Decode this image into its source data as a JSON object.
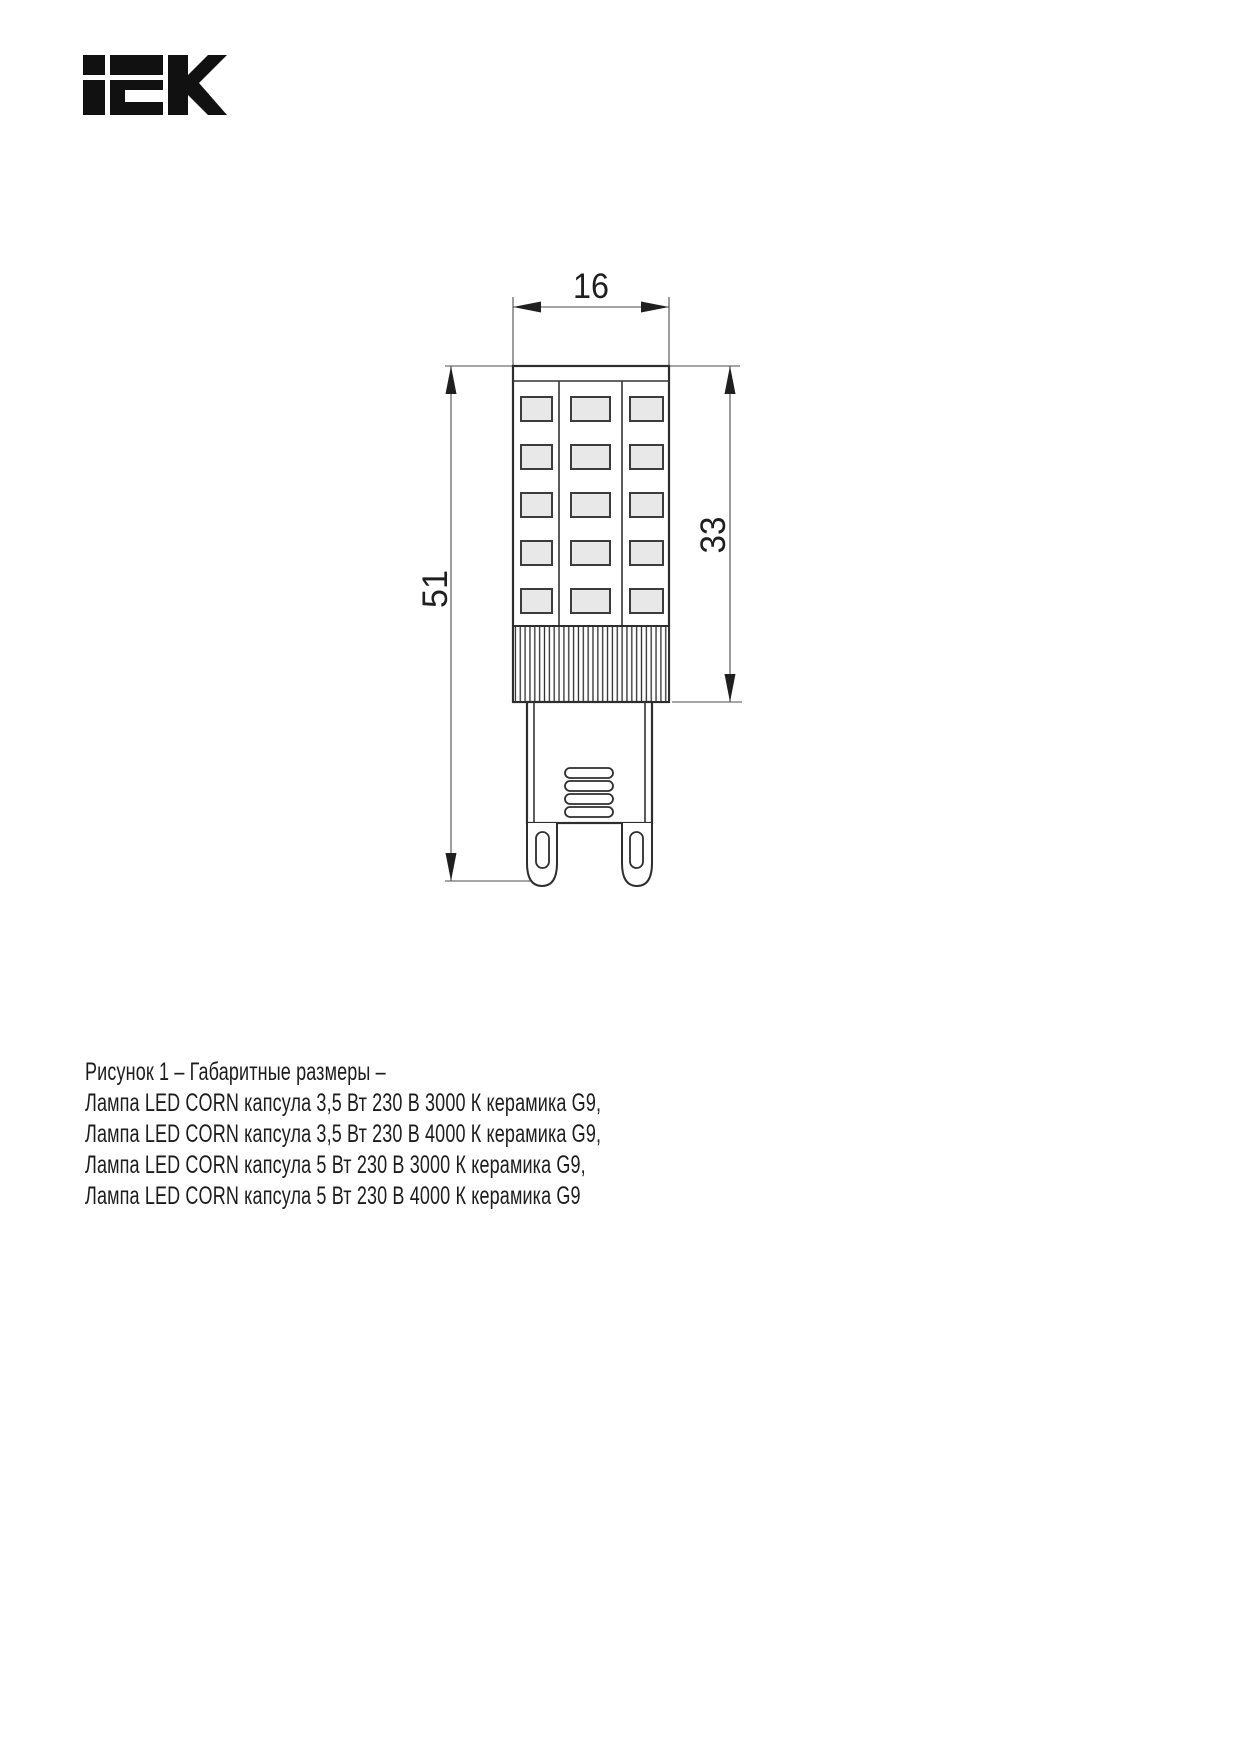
{
  "brand": {
    "name": "IEK"
  },
  "figure": {
    "dims": {
      "width": "16",
      "total_height": "51",
      "body_height": "33"
    }
  },
  "caption": {
    "lines": [
      "Рисунок 1 – Габаритные размеры –",
      "Лампа LED CORN капсула 3,5 Вт 230 В 3000 К керамика G9,",
      "Лампа LED CORN капсула 3,5 Вт 230 В 4000 К керамика G9,",
      "Лампа LED CORN капсула 5 Вт 230 В 3000 К керамика G9,",
      "Лампа LED CORN капсула 5 Вт 230 В 4000 К керамика G9"
    ]
  },
  "colors": {
    "line": "#2e2e2e",
    "thin_line": "#4d4d4d",
    "led_fill": "#e8e8e8",
    "text": "#1c1c1c",
    "logo": "#111111"
  }
}
